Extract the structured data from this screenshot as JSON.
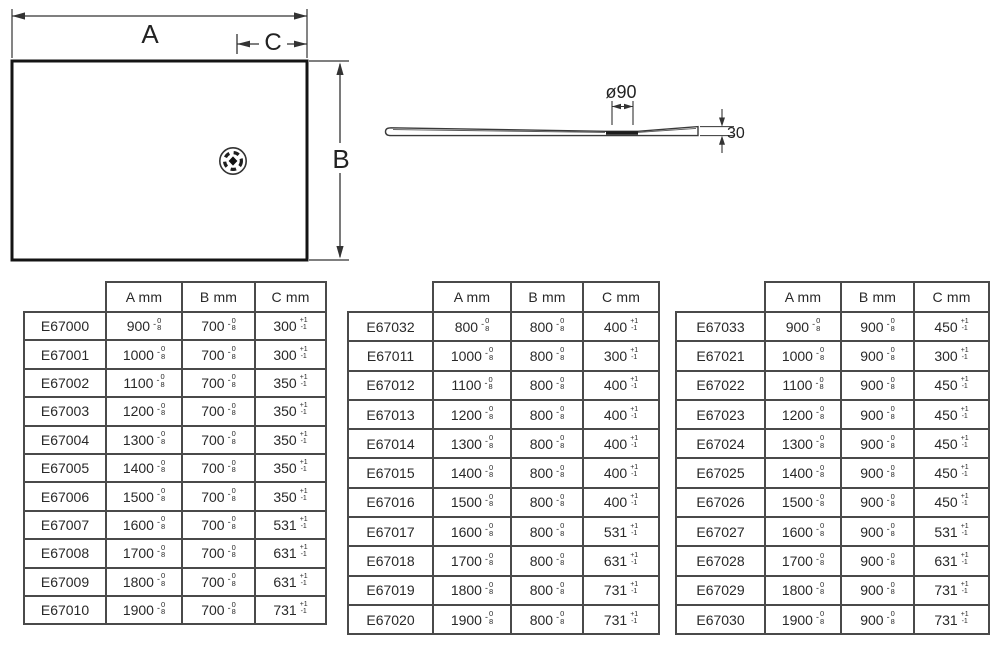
{
  "drawing": {
    "plan_view": {
      "width_label": "A",
      "height_label": "B",
      "drain_offset_label": "C"
    },
    "profile_view": {
      "drain_diameter_label": "ø90",
      "thickness_label": "30"
    }
  },
  "tolerances": {
    "dim_sign": "-",
    "dim_top": "0",
    "dim_bottom": "8",
    "c_top": "+1",
    "c_bottom": "-1"
  },
  "tables": [
    {
      "headers": [
        "",
        "A mm",
        "B mm",
        "C mm"
      ],
      "rows": [
        [
          "E67000",
          "900",
          "700",
          "300"
        ],
        [
          "E67001",
          "1000",
          "700",
          "300"
        ],
        [
          "E67002",
          "1100",
          "700",
          "350"
        ],
        [
          "E67003",
          "1200",
          "700",
          "350"
        ],
        [
          "E67004",
          "1300",
          "700",
          "350"
        ],
        [
          "E67005",
          "1400",
          "700",
          "350"
        ],
        [
          "E67006",
          "1500",
          "700",
          "350"
        ],
        [
          "E67007",
          "1600",
          "700",
          "531"
        ],
        [
          "E67008",
          "1700",
          "700",
          "631"
        ],
        [
          "E67009",
          "1800",
          "700",
          "631"
        ],
        [
          "E67010",
          "1900",
          "700",
          "731"
        ]
      ]
    },
    {
      "headers": [
        "",
        "A mm",
        "B mm",
        "C mm"
      ],
      "rows": [
        [
          "E67032",
          "800",
          "800",
          "400"
        ],
        [
          "E67011",
          "1000",
          "800",
          "300"
        ],
        [
          "E67012",
          "1100",
          "800",
          "400"
        ],
        [
          "E67013",
          "1200",
          "800",
          "400"
        ],
        [
          "E67014",
          "1300",
          "800",
          "400"
        ],
        [
          "E67015",
          "1400",
          "800",
          "400"
        ],
        [
          "E67016",
          "1500",
          "800",
          "400"
        ],
        [
          "E67017",
          "1600",
          "800",
          "531"
        ],
        [
          "E67018",
          "1700",
          "800",
          "631"
        ],
        [
          "E67019",
          "1800",
          "800",
          "731"
        ],
        [
          "E67020",
          "1900",
          "800",
          "731"
        ]
      ]
    },
    {
      "headers": [
        "",
        "A mm",
        "B mm",
        "C mm"
      ],
      "rows": [
        [
          "E67033",
          "900",
          "900",
          "450"
        ],
        [
          "E67021",
          "1000",
          "900",
          "300"
        ],
        [
          "E67022",
          "1100",
          "900",
          "450"
        ],
        [
          "E67023",
          "1200",
          "900",
          "450"
        ],
        [
          "E67024",
          "1300",
          "900",
          "450"
        ],
        [
          "E67025",
          "1400",
          "900",
          "450"
        ],
        [
          "E67026",
          "1500",
          "900",
          "450"
        ],
        [
          "E67027",
          "1600",
          "900",
          "531"
        ],
        [
          "E67028",
          "1700",
          "900",
          "631"
        ],
        [
          "E67029",
          "1800",
          "900",
          "731"
        ],
        [
          "E67030",
          "1900",
          "900",
          "731"
        ]
      ]
    }
  ]
}
